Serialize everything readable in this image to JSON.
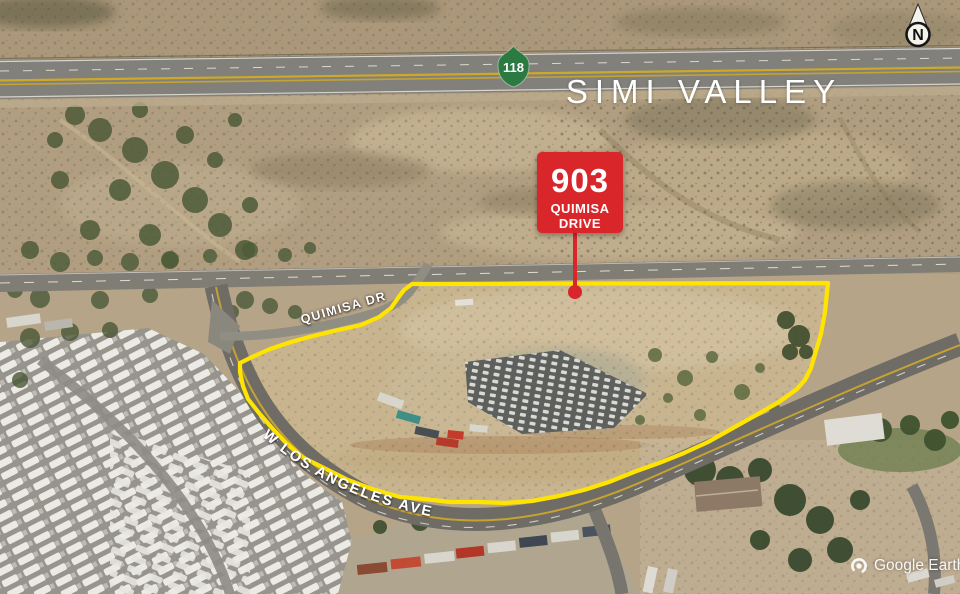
{
  "region_label": "SIMI VALLEY",
  "callout": {
    "number": "903",
    "line1": "QUIMISA",
    "line2": "DRIVE"
  },
  "highway_shield": {
    "route": "118"
  },
  "streets": {
    "quimisa_dr": "QUIMISA DR",
    "w_los_angeles_ave": "W LOS ANGELES AVE"
  },
  "compass": {
    "north_label": "N"
  },
  "watermark": {
    "brand": "Google Earth"
  },
  "colors": {
    "property_boundary": "#ffe400",
    "callout_background": "#d8262b",
    "highway_shield_green": "#2a7a42",
    "street_label_text": "#ffffff",
    "region_label_text": "#ffffff"
  }
}
